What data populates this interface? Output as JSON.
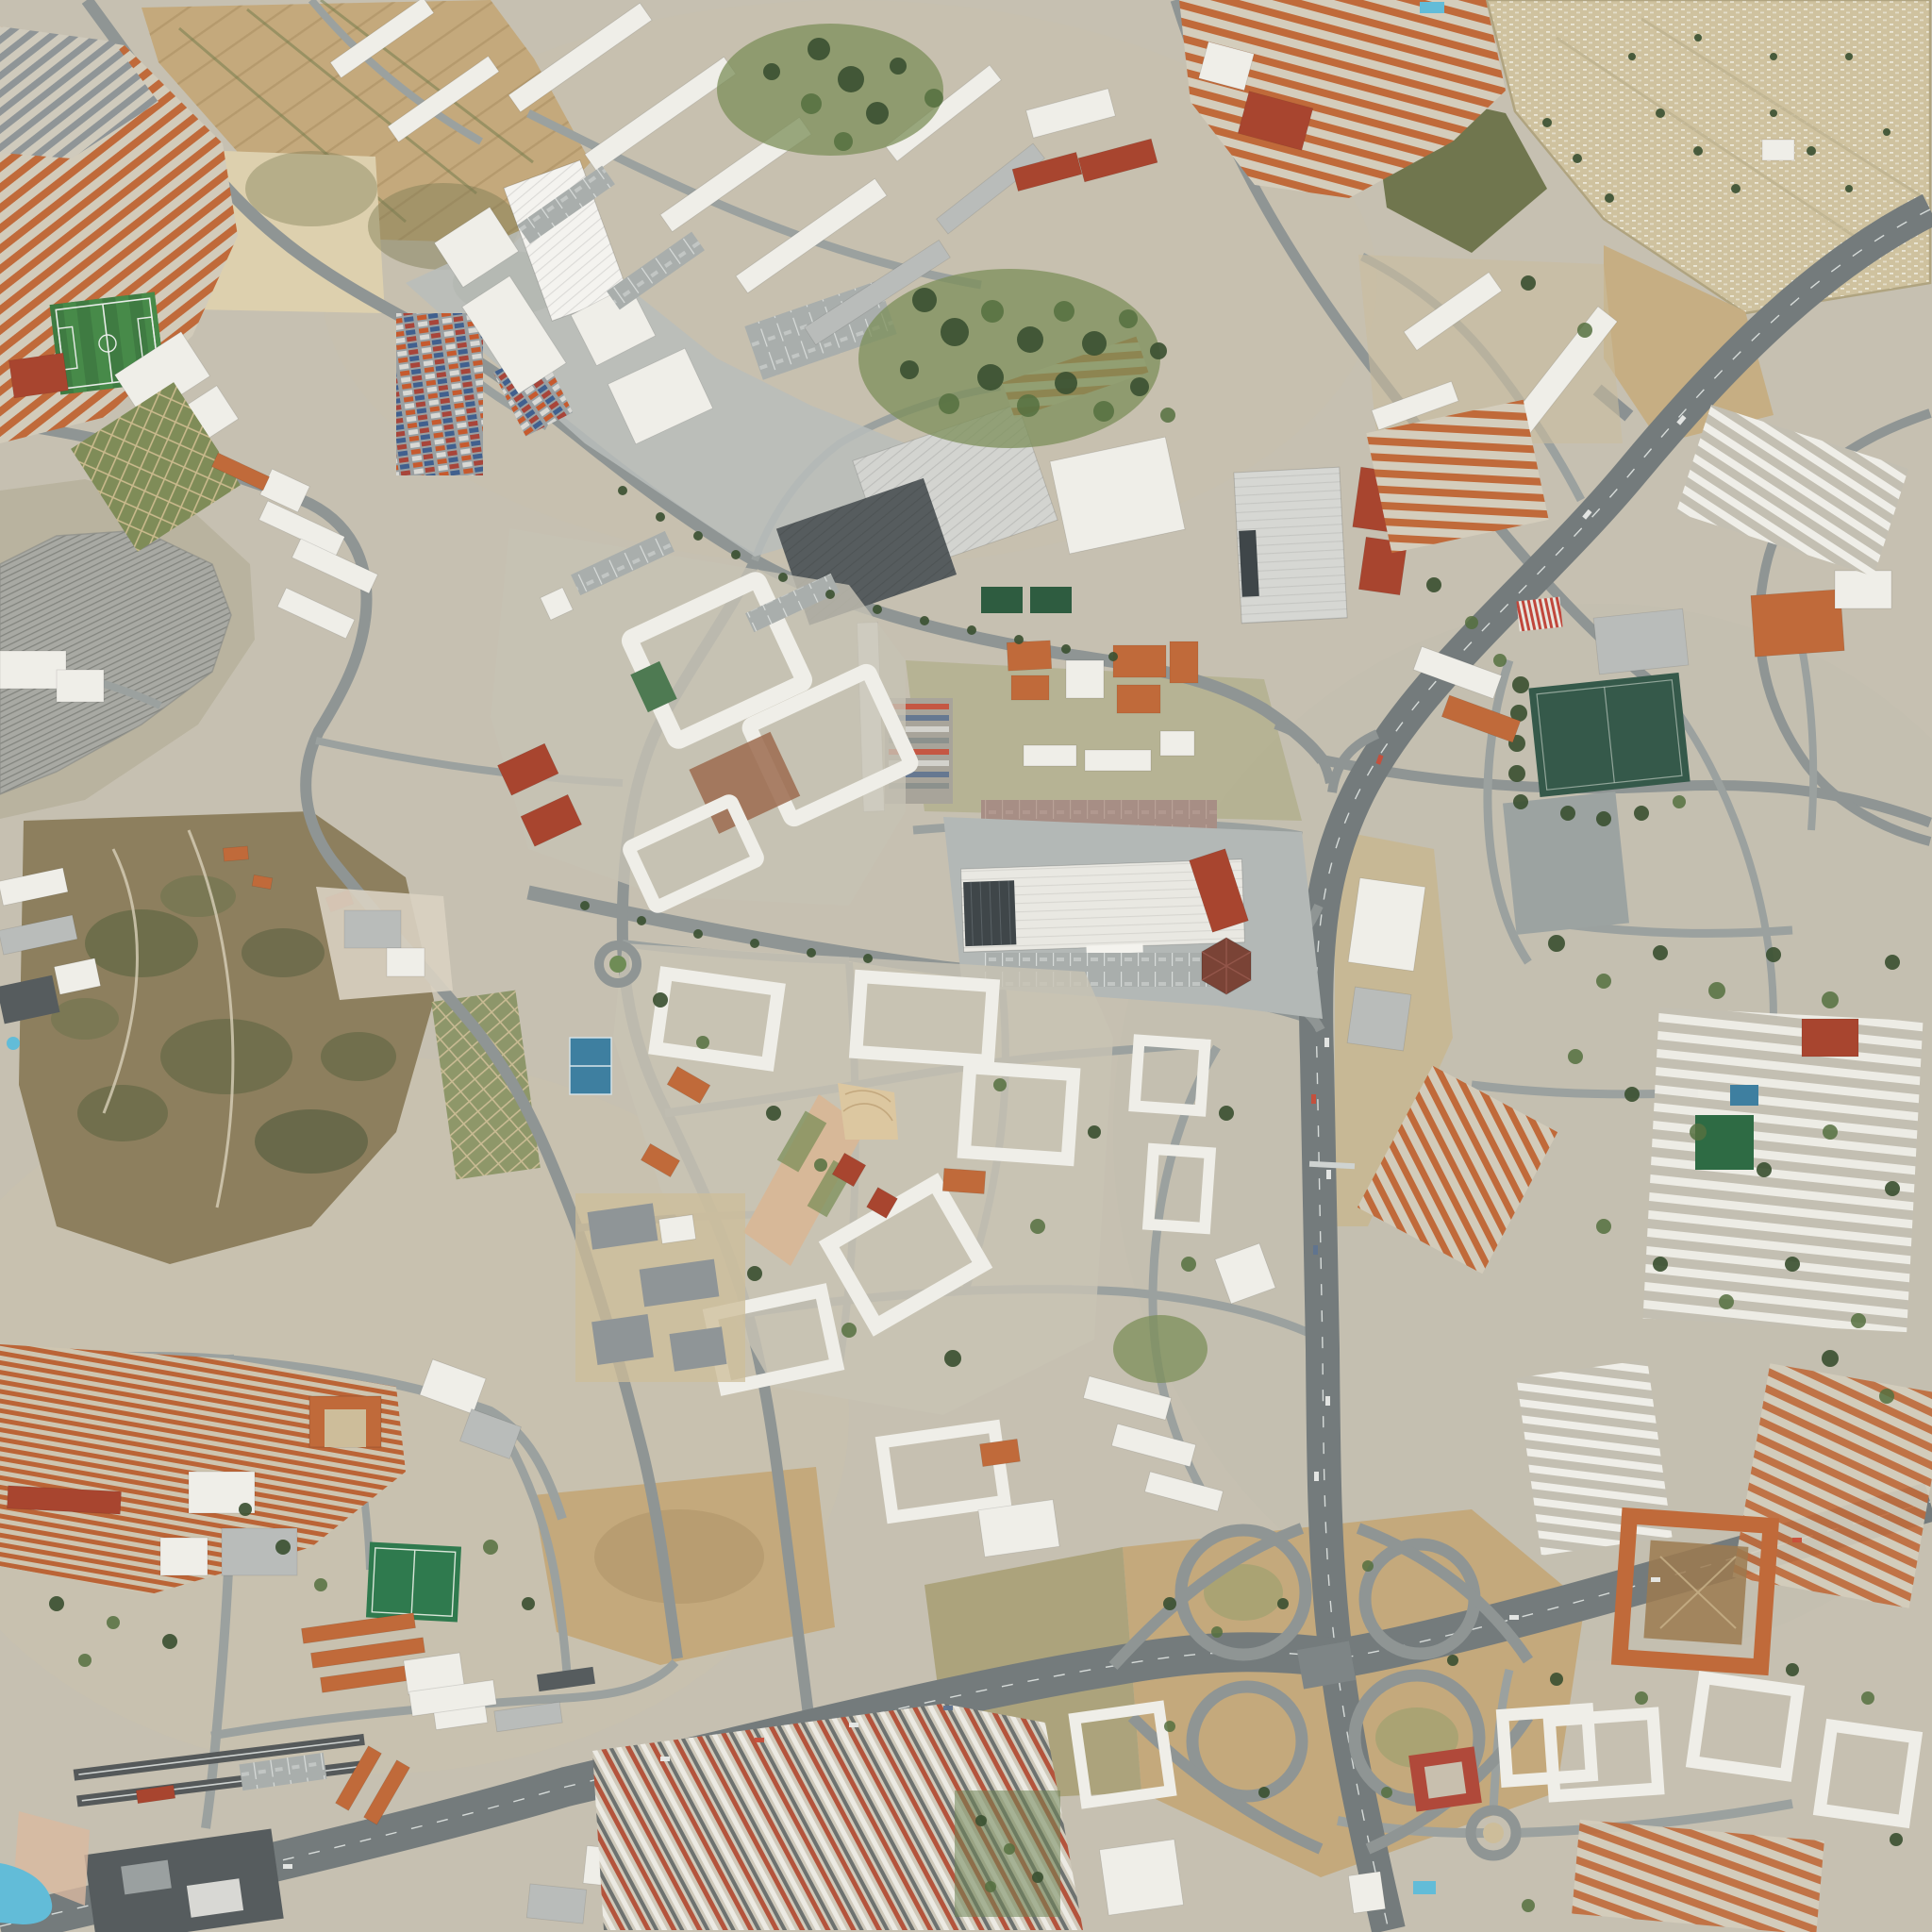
{
  "scene": {
    "type": "satellite-aerial-photograph",
    "view": "orthographic top-down city view, suburban district with Mediterranean terracotta roofs",
    "features": [
      {
        "name": "terraced-housing-northwest",
        "kind": "residential rows",
        "color_ref": "roof-orange"
      },
      {
        "name": "football-field-small",
        "kind": "sports pitch",
        "color_ref": "pitch-green"
      },
      {
        "name": "allotment-gardens",
        "kind": "garden plots",
        "color_ref": "grass-green"
      },
      {
        "name": "orchard-fields-north",
        "kind": "dry agricultural parcels",
        "color_ref": "field-tan"
      },
      {
        "name": "railway-yard",
        "kind": "rail depot with fanned tracks",
        "color_ref": "rail-bed"
      },
      {
        "name": "industrial-zone-container-yard",
        "kind": "warehouses and shipping containers",
        "color_ref": "container-orange"
      },
      {
        "name": "factory-white-main",
        "kind": "large industrial hall",
        "color_ref": "white-bldg"
      },
      {
        "name": "eastern-works-dark-shed",
        "kind": "saw-tooth roof factory",
        "color_ref": "dark-bldg"
      },
      {
        "name": "cemetery-northeast",
        "kind": "walled cemetery with cypresses",
        "color_ref": "ground-sand"
      },
      {
        "name": "motorway-north-south",
        "kind": "multi-lane motorway",
        "color_ref": "motorway"
      },
      {
        "name": "motorway-east-west",
        "kind": "multi-lane motorway",
        "color_ref": "motorway"
      },
      {
        "name": "cloverleaf-interchange",
        "kind": "motorway junction loops",
        "color_ref": "motorway"
      },
      {
        "name": "hypermarket",
        "kind": "big-box retail roof with solar array",
        "color_ref": "white-bldg"
      },
      {
        "name": "big-box-store-east",
        "kind": "ribbed retail roof",
        "color_ref": "gray-bldg"
      },
      {
        "name": "stadium-pitch-east",
        "kind": "dark green football ground with plaza",
        "color_ref": "pitch-dark"
      },
      {
        "name": "scrub-hill-southwest",
        "kind": "brush-covered open hill",
        "color_ref": "field-brown"
      },
      {
        "name": "old-town-southwest",
        "kind": "dense historic housing",
        "color_ref": "roof-orange"
      },
      {
        "name": "school-campus-south",
        "kind": "orange roofed school and turf field",
        "color_ref": "turf-green"
      },
      {
        "name": "transit-terminal-southwest",
        "kind": "dark terminal with platforms and pool",
        "color_ref": "dark-bldg"
      },
      {
        "name": "terraced-rows-south",
        "kind": "parallel housing rows",
        "color_ref": "white-bldg"
      },
      {
        "name": "courtyard-superblocks-center",
        "kind": "white perimeter apartment blocks",
        "color_ref": "white-bldg"
      },
      {
        "name": "pedestrian-mall-center",
        "kind": "paved boulevard with fan plaza",
        "color_ref": "plaza-pink"
      },
      {
        "name": "barracks-campus-orange",
        "kind": "orange roofed institutional campus",
        "color_ref": "roof-orange"
      },
      {
        "name": "courtyard-block-brown-park",
        "kind": "orange perimeter block with dirt courtyard",
        "color_ref": "roof-orange"
      },
      {
        "name": "roundabouts",
        "kind": "road circles",
        "color_ref": "road"
      },
      {
        "name": "swimming-pools",
        "kind": "blue pools",
        "color_ref": "pool-blue"
      },
      {
        "name": "sport-courts-blue",
        "kind": "hard courts",
        "color_ref": "court-blue"
      }
    ]
  },
  "palette": {
    "ground-urban": "#c6c0b1",
    "ground-light": "#d4cec0",
    "ground-sand": "#ddd0ae",
    "field-tan": "#c4a97c",
    "field-brown": "#8d7f5e",
    "grass-dry": "#9aa06e",
    "grass-green": "#7c8f5a",
    "tree-dark": "#3c5132",
    "tree-mid": "#55703f",
    "pitch-green": "#3f7b42",
    "pitch-dark": "#35594a",
    "turf-green": "#2f7a4e",
    "road": "#8f9594",
    "road-minor": "#9ba19f",
    "motorway": "#747b7c",
    "rail-bed": "#a8a9a3",
    "rail-track": "#83857f",
    "white-bldg": "#efeee8",
    "gray-bldg": "#b9bcba",
    "slate-bldg": "#8f9597",
    "dark-bldg": "#565c5e",
    "roof-orange": "#c06a3a",
    "roof-red": "#a8452f",
    "solar-dark": "#3f4649",
    "container-orange": "#c65a2e",
    "container-blue": "#41608e",
    "pool-blue": "#62bcd8",
    "court-blue": "#3e7fa0",
    "plaza-pink": "#d7b898",
    "plaza-tan": "#dcc7a0",
    "brown-roof": "#7a4336",
    "lane-white": "#e8ecea"
  }
}
